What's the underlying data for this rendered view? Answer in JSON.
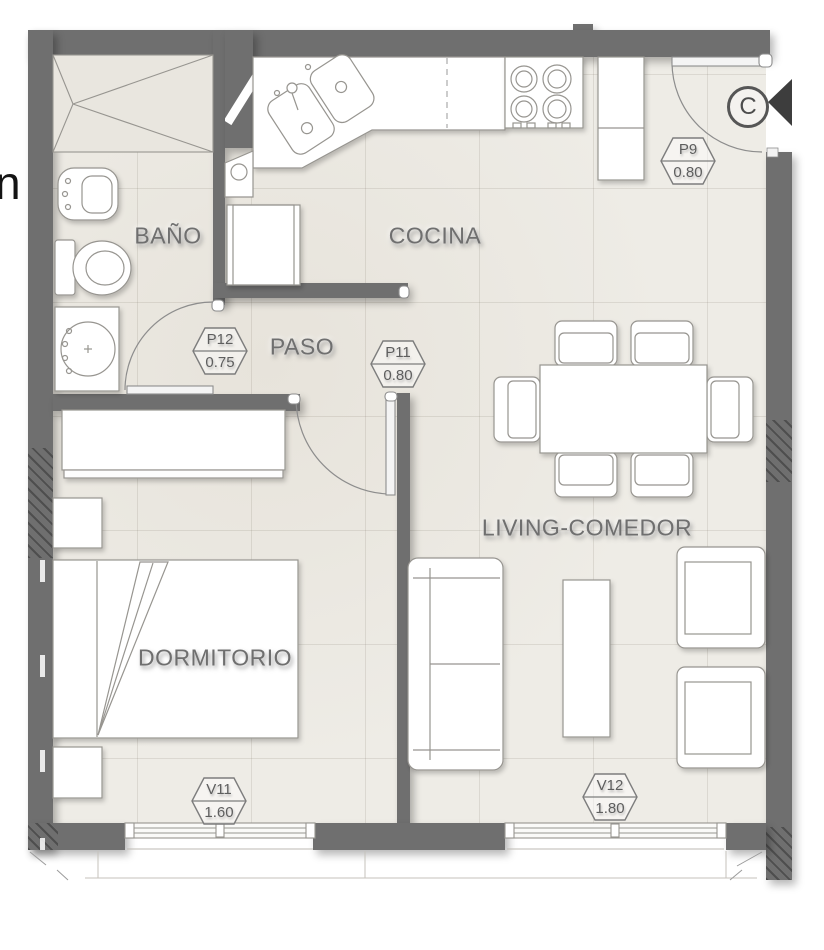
{
  "plan": {
    "outside_text": "n",
    "rooms": {
      "bano": "BAÑO",
      "cocina": "COCINA",
      "paso": "PASO",
      "dormitorio": "DORMITORIO",
      "living": "LIVING-COMEDOR"
    },
    "openings": {
      "p9": {
        "code": "P9",
        "size": "0.80"
      },
      "p12": {
        "code": "P12",
        "size": "0.75"
      },
      "p11": {
        "code": "P11",
        "size": "0.80"
      },
      "v11": {
        "code": "V11",
        "size": "1.60"
      },
      "v12": {
        "code": "V12",
        "size": "1.80"
      }
    },
    "section_marker": "C",
    "colors": {
      "wall": "#6f6f6f",
      "floor": "#eeece6",
      "fixture_stroke": "#979590",
      "label_text": "#6f6f6f"
    }
  }
}
